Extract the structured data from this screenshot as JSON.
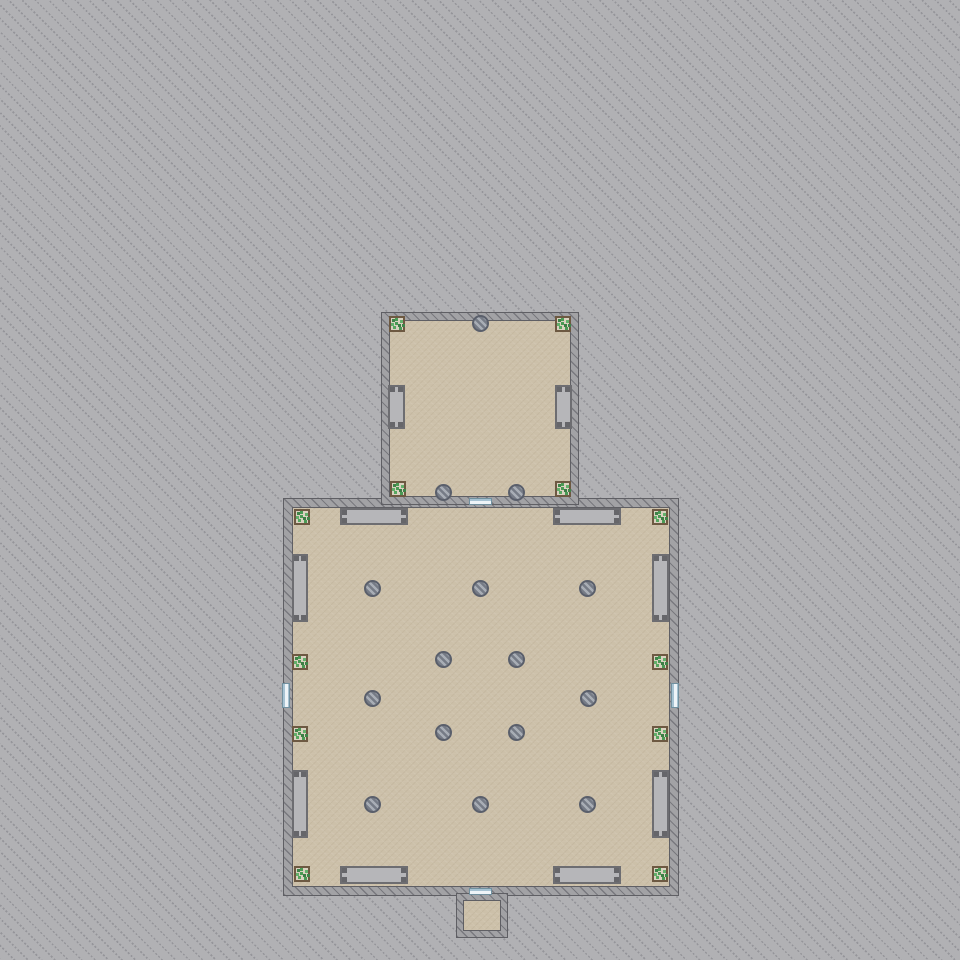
{
  "scene": {
    "canvas": {
      "width": 960,
      "height": 960
    },
    "colors": {
      "terrain": "#b1b1b4",
      "terrain_line": "#95959a",
      "wall_fill": "#a2a2a5",
      "wall_outline": "#5f5f64",
      "floor": "#ccc0a9",
      "bench_fill": "#b6b6b9",
      "bench_frame": "#6d6d71",
      "plant_frame": "#6d5942",
      "plant_leaf": "#4a9a55",
      "vent_ring": "#5a5f6b",
      "door_fill": "#a6c2d2",
      "door_center": "#eef4f8"
    },
    "rooms": [
      {
        "name": "main-hall",
        "x": 283,
        "y": 498,
        "w": 396,
        "h": 398,
        "wall": 8
      },
      {
        "name": "upper-room",
        "x": 381,
        "y": 312,
        "w": 198,
        "h": 193,
        "wall": 7
      },
      {
        "name": "vestibule",
        "x": 456,
        "y": 893,
        "w": 52,
        "h": 45,
        "wall": 6
      }
    ],
    "window_benches": [
      {
        "room": "upper-room",
        "x": 388,
        "y": 385,
        "w": 17,
        "h": 44
      },
      {
        "room": "upper-room",
        "x": 555,
        "y": 385,
        "w": 17,
        "h": 44
      },
      {
        "room": "main-hall",
        "x": 340,
        "y": 508,
        "w": 68,
        "h": 17
      },
      {
        "room": "main-hall",
        "x": 553,
        "y": 508,
        "w": 68,
        "h": 17
      },
      {
        "room": "main-hall",
        "x": 340,
        "y": 866,
        "w": 68,
        "h": 18
      },
      {
        "room": "main-hall",
        "x": 553,
        "y": 866,
        "w": 68,
        "h": 18
      },
      {
        "room": "main-hall",
        "x": 292,
        "y": 554,
        "w": 16,
        "h": 68
      },
      {
        "room": "main-hall",
        "x": 292,
        "y": 770,
        "w": 16,
        "h": 68
      },
      {
        "room": "main-hall",
        "x": 652,
        "y": 554,
        "w": 17,
        "h": 68
      },
      {
        "room": "main-hall",
        "x": 652,
        "y": 770,
        "w": 17,
        "h": 68
      }
    ],
    "plants": [
      {
        "x": 389,
        "y": 316
      },
      {
        "x": 555,
        "y": 316
      },
      {
        "x": 390,
        "y": 481
      },
      {
        "x": 555,
        "y": 481
      },
      {
        "x": 294,
        "y": 509
      },
      {
        "x": 652,
        "y": 509
      },
      {
        "x": 294,
        "y": 866
      },
      {
        "x": 652,
        "y": 866
      },
      {
        "x": 292,
        "y": 654
      },
      {
        "x": 292,
        "y": 726
      },
      {
        "x": 652,
        "y": 654
      },
      {
        "x": 652,
        "y": 726
      }
    ],
    "vents": [
      {
        "x": 480,
        "y": 323
      },
      {
        "x": 443,
        "y": 492
      },
      {
        "x": 516,
        "y": 492
      },
      {
        "x": 372,
        "y": 588
      },
      {
        "x": 480,
        "y": 588
      },
      {
        "x": 587,
        "y": 588
      },
      {
        "x": 443,
        "y": 659
      },
      {
        "x": 516,
        "y": 659
      },
      {
        "x": 372,
        "y": 698
      },
      {
        "x": 588,
        "y": 698
      },
      {
        "x": 443,
        "y": 732
      },
      {
        "x": 516,
        "y": 732
      },
      {
        "x": 372,
        "y": 804
      },
      {
        "x": 480,
        "y": 804
      },
      {
        "x": 587,
        "y": 804
      }
    ],
    "doors": [
      {
        "name": "door-upper-to-main",
        "x": 469,
        "y": 498,
        "w": 23,
        "h": 7,
        "orient": "h"
      },
      {
        "name": "door-main-west",
        "x": 282,
        "y": 683,
        "w": 8,
        "h": 25,
        "orient": "v"
      },
      {
        "name": "door-main-east",
        "x": 671,
        "y": 683,
        "w": 8,
        "h": 25,
        "orient": "v"
      },
      {
        "name": "door-main-to-vestibule",
        "x": 469,
        "y": 888,
        "w": 23,
        "h": 7,
        "orient": "h"
      }
    ]
  }
}
